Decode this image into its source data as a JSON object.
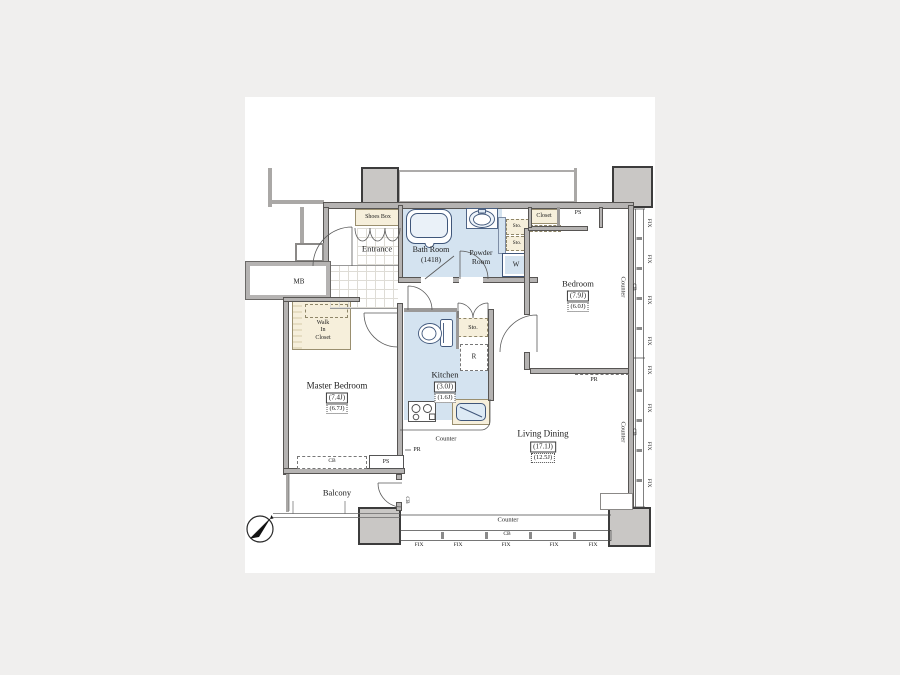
{
  "colors": {
    "water_area": "#d4e3f0",
    "storage_area": "#f6efdb",
    "wall": "#b5b3b2",
    "pillar": "#c9c7c5",
    "fixture_outline": "#3f567a",
    "background": "#f0efee"
  },
  "rooms": {
    "entrance": "Entrance",
    "shoes_box": "Shoes Box",
    "bath_room": "Bath Room",
    "bath_size": "(1418)",
    "powder_line1": "Powder",
    "powder_line2": "Room",
    "washer": "W",
    "closet": "Closet",
    "bedroom": "Bedroom",
    "bedroom_size": "(7.9J)",
    "bedroom_size_net": "(6.0J)",
    "meter_box": "MB",
    "wic_line1": "Walk",
    "wic_line2": "In",
    "wic_line3": "Closet",
    "master_bedroom": "Master Bedroom",
    "master_size": "(7.4J)",
    "master_size_net": "(6.7J)",
    "kitchen": "Kitchen",
    "kitchen_size": "(3.0J)",
    "kitchen_size_net": "(1.6J)",
    "fridge": "R",
    "living_dining": "Living Dining",
    "living_size": "(17.1J)",
    "living_size_net": "(12.5J)",
    "balcony": "Balcony"
  },
  "labels": {
    "fix": "FIX",
    "sto": "Sto.",
    "counter": "Counter",
    "cb": "CB",
    "ps": "PS",
    "pr": "PR"
  }
}
